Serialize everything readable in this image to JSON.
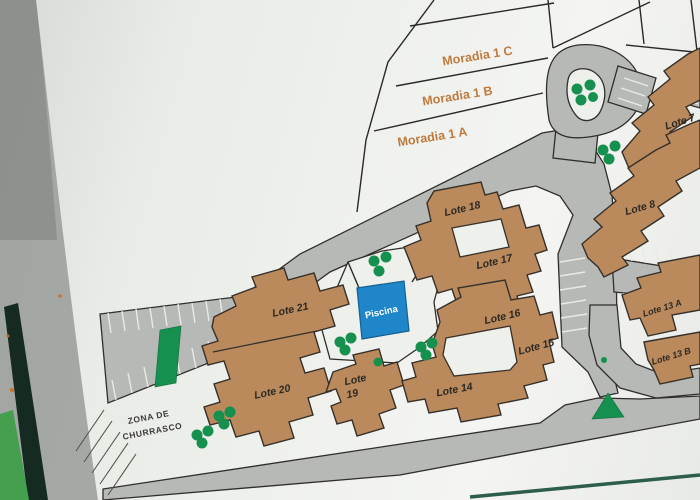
{
  "sign": {
    "labels": {
      "moradia_1c": "Moradia 1 C",
      "moradia_1b": "Moradia 1 B",
      "moradia_1a": "Moradia 1 A",
      "lote7": "Lote 7",
      "lote8": "Lote 8",
      "lote13a": "Lote 13 A",
      "lote13b": "Lote 13 B",
      "lote14": "Lote 14",
      "lote15": "Lote 15",
      "lote16": "Lote 16",
      "lote17": "Lote 17",
      "lote18": "Lote 18",
      "lote19_line1": "Lote",
      "lote19_line2": "19",
      "lote20": "Lote 20",
      "lote21": "Lote 21",
      "piscina": "Piscina",
      "bbq_line1": "ZONA DE",
      "bbq_line2": "CHURRASCO"
    },
    "colors": {
      "board": "#eef0ec",
      "road": "#b6b9b5",
      "building": "#ba8a5d",
      "tree": "#15904e",
      "pool": "#1e86c9",
      "lot_label": "#2d2923",
      "moradia_label": "#bf7a3e",
      "frame": "#152a20",
      "grass": "#44a04e"
    }
  }
}
